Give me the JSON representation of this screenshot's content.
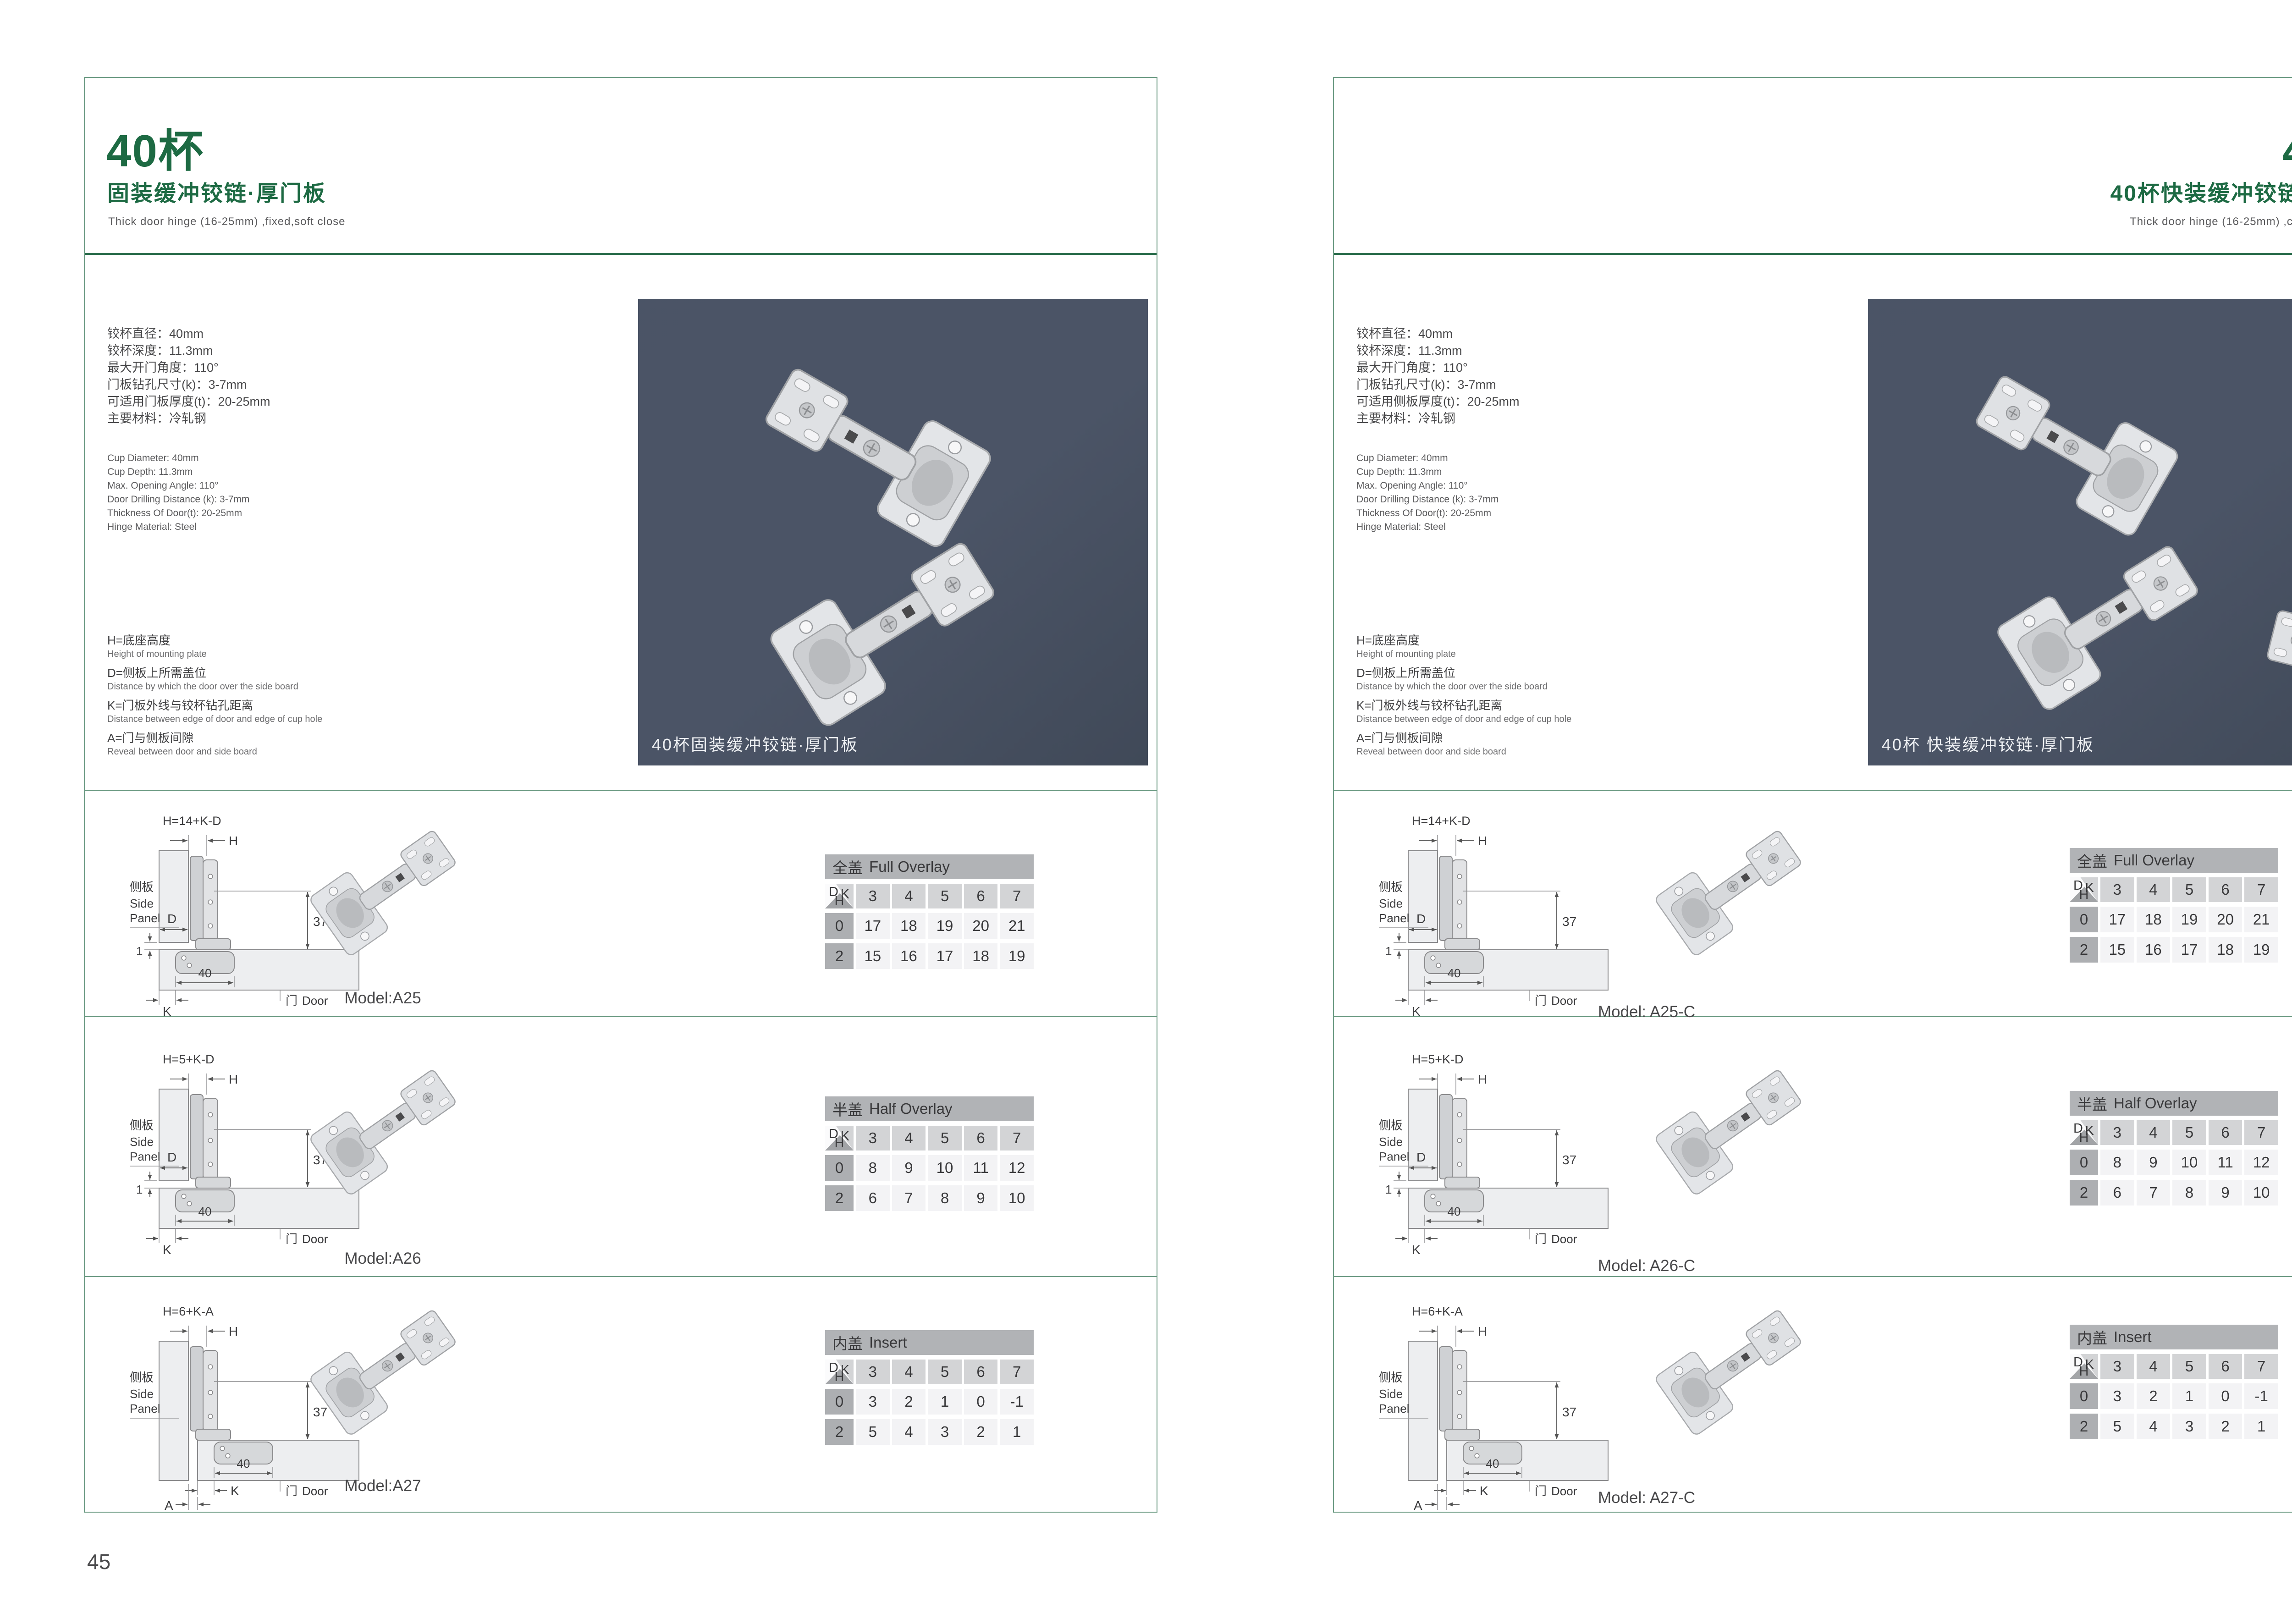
{
  "shared": {
    "diagram": {
      "side_panel_cn": "侧板",
      "side_panel_en_1": "Side",
      "side_panel_en_2": "Panel",
      "door_cn": "门",
      "door_en": "Door",
      "dim_h": "H",
      "dim_37": "37",
      "dim_d": "D",
      "dim_1": "1",
      "dim_40": "40",
      "dim_k": "K",
      "dim_a": "A"
    },
    "formulas": [
      "H=14+K-D",
      "H=5+K-D",
      "H=6+K-A"
    ],
    "table_corner": {
      "d": "D",
      "k": "K",
      "h": "H"
    },
    "columns": [
      "3",
      "4",
      "5",
      "6",
      "7"
    ],
    "tables": [
      {
        "title_cn": "全盖",
        "title_en": "Full Overlay",
        "rows": [
          {
            "label": "0",
            "values": [
              "17",
              "18",
              "19",
              "20",
              "21"
            ]
          },
          {
            "label": "2",
            "values": [
              "15",
              "16",
              "17",
              "18",
              "19"
            ]
          }
        ]
      },
      {
        "title_cn": "半盖",
        "title_en": "Half Overlay",
        "rows": [
          {
            "label": "0",
            "values": [
              "8",
              "9",
              "10",
              "11",
              "12"
            ]
          },
          {
            "label": "2",
            "values": [
              "6",
              "7",
              "8",
              "9",
              "10"
            ]
          }
        ]
      },
      {
        "title_cn": "内盖",
        "title_en": "Insert",
        "rows": [
          {
            "label": "0",
            "values": [
              "3",
              "2",
              "1",
              "0",
              "-1"
            ]
          },
          {
            "label": "2",
            "values": [
              "5",
              "4",
              "3",
              "2",
              "1"
            ]
          }
        ]
      }
    ]
  },
  "left_page": {
    "page_number": "45",
    "title": "40杯",
    "subtitle": "固装缓冲铰链·厚门板",
    "tagline": "Thick door hinge (16-25mm)  ,fixed,soft close",
    "specs_cn": [
      "铰杯直径：40mm",
      "铰杯深度：11.3mm",
      "最大开门角度：110°",
      "门板钻孔尺寸(k)：3-7mm",
      "可适用门板厚度(t)：20-25mm",
      "主要材料：冷轧钢"
    ],
    "specs_en": [
      "Cup Diameter: 40mm",
      "Cup Depth: 11.3mm",
      "Max. Opening Angle: 110°",
      "Door Drilling Distance (k): 3-7mm",
      "Thickness Of Door(t): 20-25mm",
      "Hinge Material: Steel"
    ],
    "legend": [
      {
        "cn": "H=底座高度",
        "en": "Height of mounting plate"
      },
      {
        "cn": "D=侧板上所需盖位",
        "en": "Distance by which the door over the side board"
      },
      {
        "cn": "K=门板外线与铰杯钻孔距离",
        "en": "Distance between edge of door and edge of cup hole"
      },
      {
        "cn": "A=门与侧板间隙",
        "en": "Reveal between door and side board"
      }
    ],
    "photo_caption": "40杯固装缓冲铰链·厚门板",
    "models": [
      "Model:A25",
      "Model:A26",
      "Model:A27"
    ]
  },
  "right_page": {
    "page_number": "46",
    "title": "40杯",
    "subtitle": "40杯快装缓冲铰链·厚门板",
    "tagline": "Thick door hinge (16-25mm)  ,clip on ,soft close",
    "specs_cn": [
      "铰杯直径：40mm",
      "铰杯深度：11.3mm",
      "最大开门角度：110°",
      "门板钻孔尺寸(k)：3-7mm",
      "可适用侧板厚度(t)：20-25mm",
      "主要材料：冷轧钢"
    ],
    "specs_en": [
      "Cup Diameter: 40mm",
      "Cup Depth: 11.3mm",
      "Max. Opening Angle: 110°",
      "Door Drilling Distance (k): 3-7mm",
      "Thickness Of Door(t): 20-25mm",
      "Hinge Material: Steel"
    ],
    "legend": [
      {
        "cn": "H=底座高度",
        "en": "Height of mounting plate"
      },
      {
        "cn": "D=侧板上所需盖位",
        "en": "Distance by which the door over the side board"
      },
      {
        "cn": "K=门板外线与铰杯钻孔距离",
        "en": "Distance between edge of door and edge of cup hole"
      },
      {
        "cn": "A=门与侧板间隙",
        "en": "Reveal between door and side board"
      }
    ],
    "photo_caption": "40杯 快装缓冲铰链·厚门板",
    "models": [
      "Model: A25-C",
      "Model: A26-C",
      "Model: A27-C"
    ]
  },
  "colors": {
    "accent_green": "#1d6a43",
    "frame_line": "#6e9c85",
    "header_rule": "#2e6f4f",
    "photo_bg": "#4b5466",
    "table_title_bg": "#b1b3b6",
    "table_header_bg": "#d3d4d6",
    "table_label_bg": "#adafb2",
    "table_cell_bg": "#f3f3f5"
  }
}
